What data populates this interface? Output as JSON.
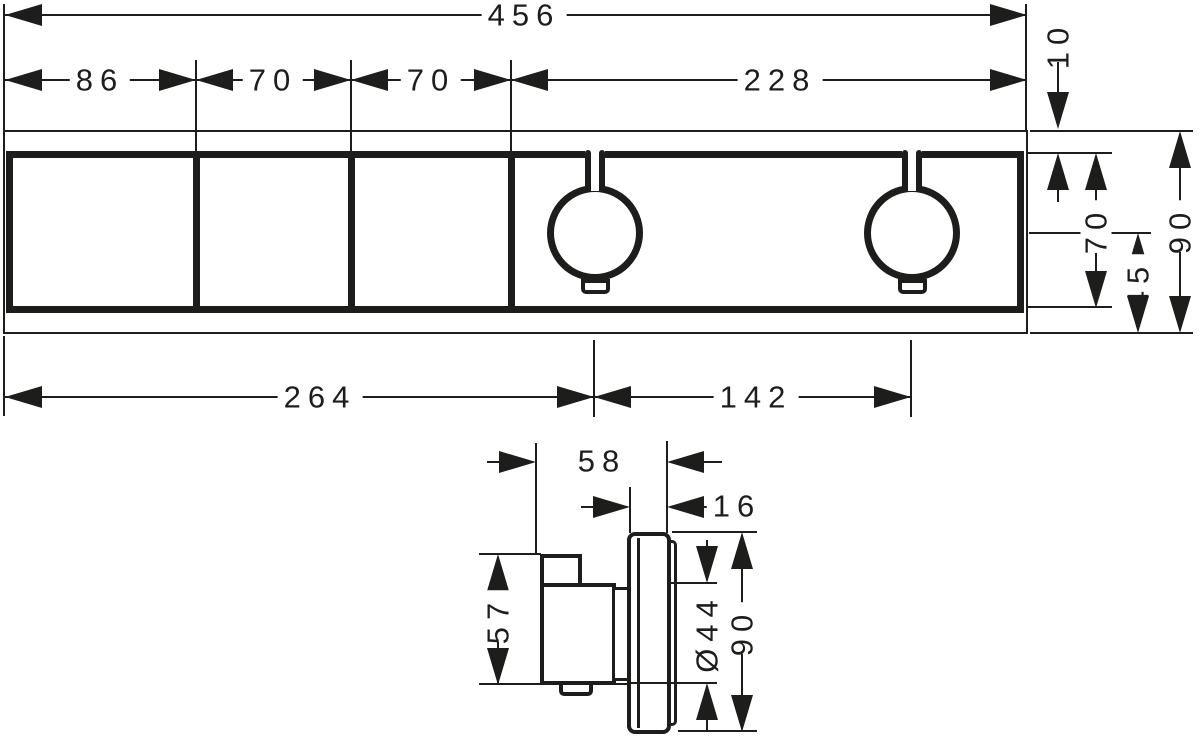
{
  "drawing": {
    "type": "technical-dimension-drawing",
    "views": {
      "front": "front view of rectangular trim plate with 3 select panels and 2 thermostat knobs",
      "side": "side profile of concealed valve body and escutcheon"
    },
    "ink_color": "#1d1d1b",
    "background_color": "#ffffff"
  },
  "dims": {
    "front": {
      "overall_width": "456",
      "segment_1": "86",
      "segment_2": "70",
      "segment_3": "70",
      "segment_4": "228",
      "top_offset": "10",
      "unit_height": "70",
      "center_to_bottom": "45",
      "overall_height": "90",
      "left_to_first_knob": "264",
      "knob_spacing": "142"
    },
    "side": {
      "total_depth": "58",
      "escutcheon_depth": "16",
      "body_height": "57",
      "knob_diameter": "Ø44",
      "escutcheon_height": "90"
    }
  }
}
